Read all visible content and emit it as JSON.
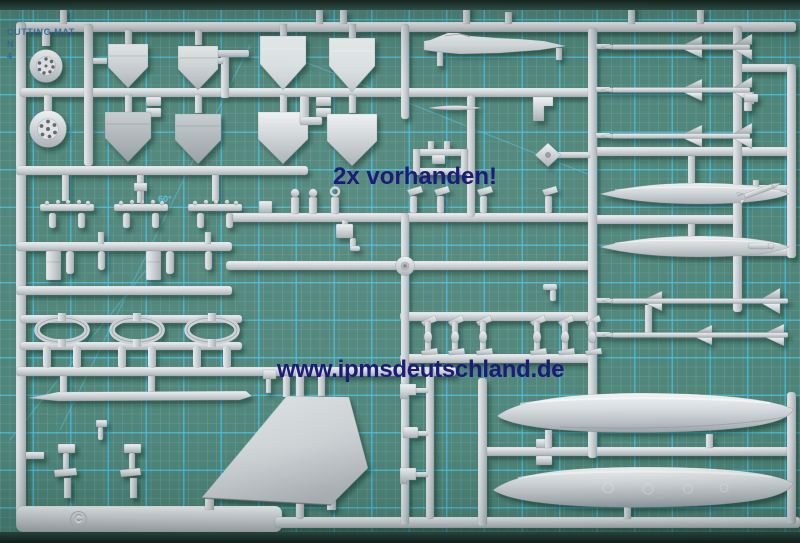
{
  "mat": {
    "print_line1": "CUTTING MAT",
    "print_line2": "N",
    "print_line3": "4",
    "angle_label": "60°",
    "surface_color": "#4e8478",
    "grid_color": "#45b9dd",
    "edge_color": "#20312b"
  },
  "overlays": {
    "note_text": "2x vorhanden!",
    "watermark_text": "www.ipmsdeutschland.de",
    "text_color": "#1c1b7a"
  },
  "sprue": {
    "gate_letter": "C",
    "plastic_color": "#cbd0d4"
  }
}
